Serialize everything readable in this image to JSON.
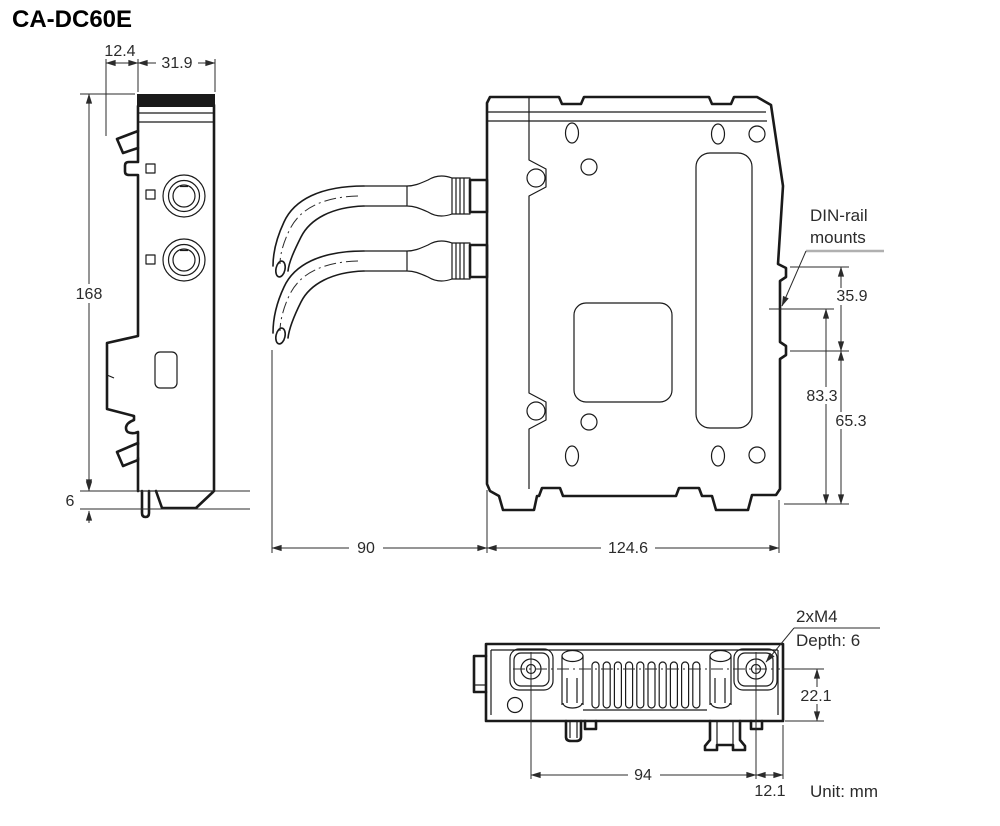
{
  "title": "CA-DC60E",
  "unit": "Unit: mm",
  "side_view": {
    "dim_hook_depth": "12.4",
    "dim_width": "31.9",
    "dim_height": "168",
    "dim_foot": "6"
  },
  "front_view": {
    "dim_cable": "90",
    "dim_width": "124.6",
    "dim_mount_height": "35.9",
    "dim_mount_to_bottom_outer": "83.3",
    "dim_mount_to_bottom_inner": "65.3",
    "label_din_line1": "DIN-rail",
    "label_din_line2": "mounts"
  },
  "bottom_view": {
    "dim_screw_pitch": "94",
    "dim_screw_to_edge": "12.1",
    "dim_depth": "22.1",
    "note_screw": "2xM4",
    "note_depth": "Depth: 6"
  }
}
